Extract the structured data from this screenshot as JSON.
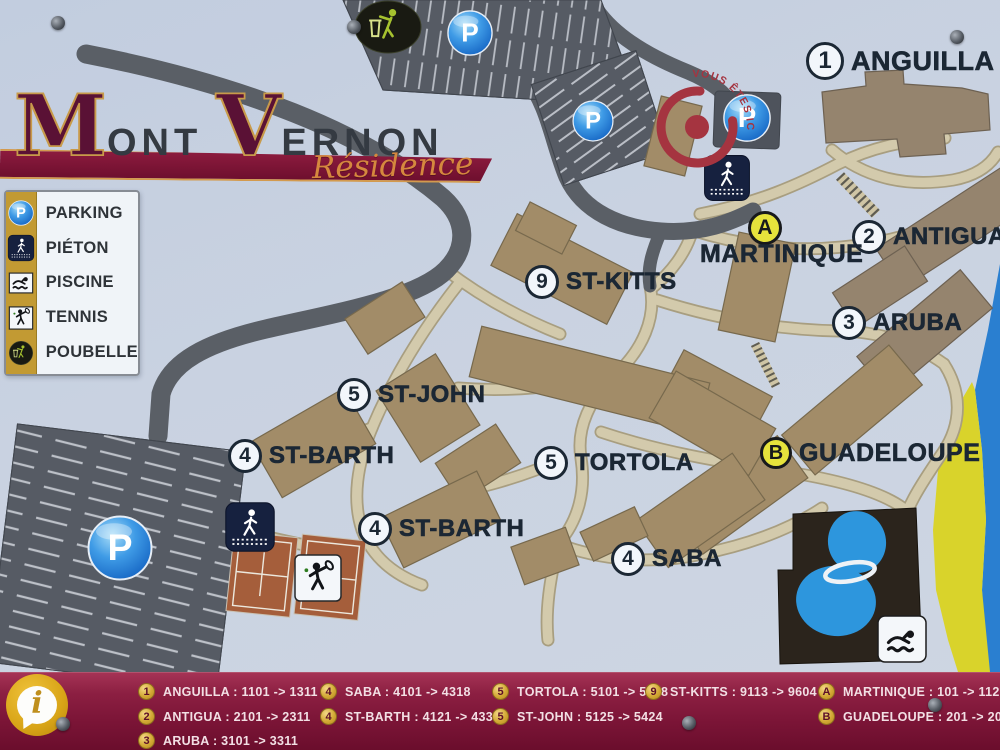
{
  "glyphs": {
    "parking": "P",
    "info": "i"
  },
  "title": {
    "word1_initial": "M",
    "word1_rest": "ONT",
    "word2_initial": "V",
    "word2_rest": "ERNON",
    "subtitle": "Résidence"
  },
  "legend": {
    "items": [
      {
        "icon": "parking-icon",
        "label": "PARKING"
      },
      {
        "icon": "pedestrian-icon",
        "label": "PIÉTON"
      },
      {
        "icon": "pool-icon",
        "label": "PISCINE"
      },
      {
        "icon": "tennis-icon",
        "label": "TENNIS"
      },
      {
        "icon": "trash-icon",
        "label": "POUBELLE"
      }
    ]
  },
  "map": {
    "you_are_here": "VOUS ÊTES ICI",
    "labels": [
      {
        "badge": "1",
        "name": "ANGUILLA"
      },
      {
        "badge": "2",
        "name": "ANTIGUA"
      },
      {
        "badge": "3",
        "name": "ARUBA"
      },
      {
        "badge": "9",
        "name": "ST-KITTS"
      },
      {
        "badge": "5",
        "name": "ST-JOHN"
      },
      {
        "badge": "4",
        "name": "ST-BARTH"
      },
      {
        "badge": "5",
        "name": "TORTOLA"
      },
      {
        "badge": "4",
        "name": "ST-BARTH"
      },
      {
        "badge": "4",
        "name": "SABA"
      },
      {
        "badge": "A",
        "name": "MARTINIQUE"
      },
      {
        "badge": "B",
        "name": "GUADELOUPE"
      }
    ]
  },
  "directory": {
    "entries": [
      {
        "badge": "1",
        "text": "ANGUILLA : 1101 -> 1311"
      },
      {
        "badge": "2",
        "text": "ANTIGUA : 2101 -> 2311"
      },
      {
        "badge": "3",
        "text": "ARUBA : 3101 -> 3311"
      },
      {
        "badge": "4",
        "text": "SABA : 4101 -> 4318"
      },
      {
        "badge": "4",
        "text": "ST-BARTH : 4121 -> 4338"
      },
      {
        "badge": "5",
        "text": "TORTOLA : 5101 -> 5318"
      },
      {
        "badge": "5",
        "text": "ST-JOHN : 5125 -> 5424"
      },
      {
        "badge": "9",
        "text": "ST-KITTS : 9113 -> 9604"
      },
      {
        "badge": "A",
        "text": "MARTINIQUE : 101 -> 112"
      },
      {
        "badge": "B",
        "text": "GUADELOUPE : 201 -> 208"
      }
    ]
  },
  "colors": {
    "maroon": "#7c1537",
    "gold": "#c29a33",
    "label_navy": "#1b2734",
    "building_tan": "#a28c68",
    "road_dark": "#5a5f66",
    "path_beige": "#d3caac",
    "pool_blue": "#2d96dd",
    "beach_yellow": "#d9d32b",
    "ocean_blue": "#2a7fd0",
    "badge_yellow": "#e6e33c"
  }
}
